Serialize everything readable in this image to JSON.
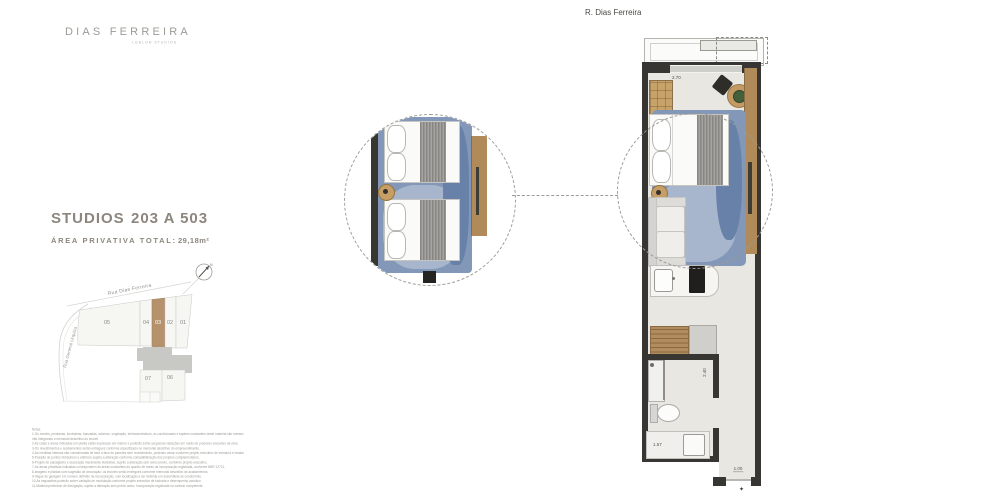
{
  "logo": {
    "title": "DIAS FERREIRA",
    "subtitle": "LEBLON STUDIOS"
  },
  "street_label_top": "R. Dias Ferreira",
  "unit_info": {
    "type_label": "STUDIOS",
    "range_label": "203 A 503",
    "area_label": "ÁREA PRIVATIVA TOTAL:",
    "area_value": "29,18m²"
  },
  "site_map": {
    "streets": {
      "top": "Rua Dias Ferreira",
      "left": "Rua General Urquiza"
    },
    "compass_label": "N",
    "lots": [
      "05",
      "04",
      "03",
      "02",
      "01",
      "07",
      "06"
    ],
    "highlighted_lot": "03"
  },
  "floor_plan": {
    "dimensions": {
      "bedroom": "2.70",
      "bath": "2.40",
      "vanity": "1.57",
      "entry": "1.00"
    },
    "entry_marker": "✦"
  },
  "disclaimer": {
    "lines": [
      "Notas:",
      "1-Os móveis, persianas, luminárias, bancadas, adornos, vegetação, eletrodomésticos, ar-condicionado e tapetes constantes deste material são meramente ilustrativos, não integrando o memorial descritivo.",
      "não integrando o memorial descritivo do imóvel.",
      "2-As cotas e áreas indicadas em planta estão expressas em metros e poderão sofrer pequenas variações em razão do processo executivo da obra.",
      "3-Os revestimentos e acabamentos serão entregues conforme especificado no memorial descritivo do empreendimento.",
      "4-As medidas internas são consideradas de face a face de paredes sem revestimento, podendo variar conforme projeto executivo de estrutura e instalações.",
      "5-Posição de pontos hidráulicos e elétricos sujeita a alteração conforme compatibilização dos projetos complementares.",
      "6-Projeto de paisagismo e decoração meramente ilustrativo, sujeito a alteração sem aviso prévio, conforme projeto executivo.",
      "7-As áreas privativas indicadas correspondem às áreas constantes do quadro de áreas da incorporação registrada, conforme NBR 12721.",
      "8-Imagens e plantas com sugestão de decoração; os imóveis serão entregues conforme memorial descritivo de acabamentos.",
      "9-Vagas de garagem em número definido na incorporação, com localização a ser definida em assembleia de condomínio.",
      "10-As esquadrias poderão sofrer variação de modulação conforme projeto executivo de fachada e desempenho acústico.",
      "11-Material preliminar de divulgação, sujeito a alteração sem prévio aviso. Incorporação registrada no cartório competente."
    ]
  },
  "colors": {
    "accent_brown": "#b5916c",
    "wood": "#b08a58",
    "wall_dark": "#383633",
    "rug_blue": "#8398b8",
    "floor": "#e9e7e2",
    "heading_gray": "#8c867d"
  }
}
